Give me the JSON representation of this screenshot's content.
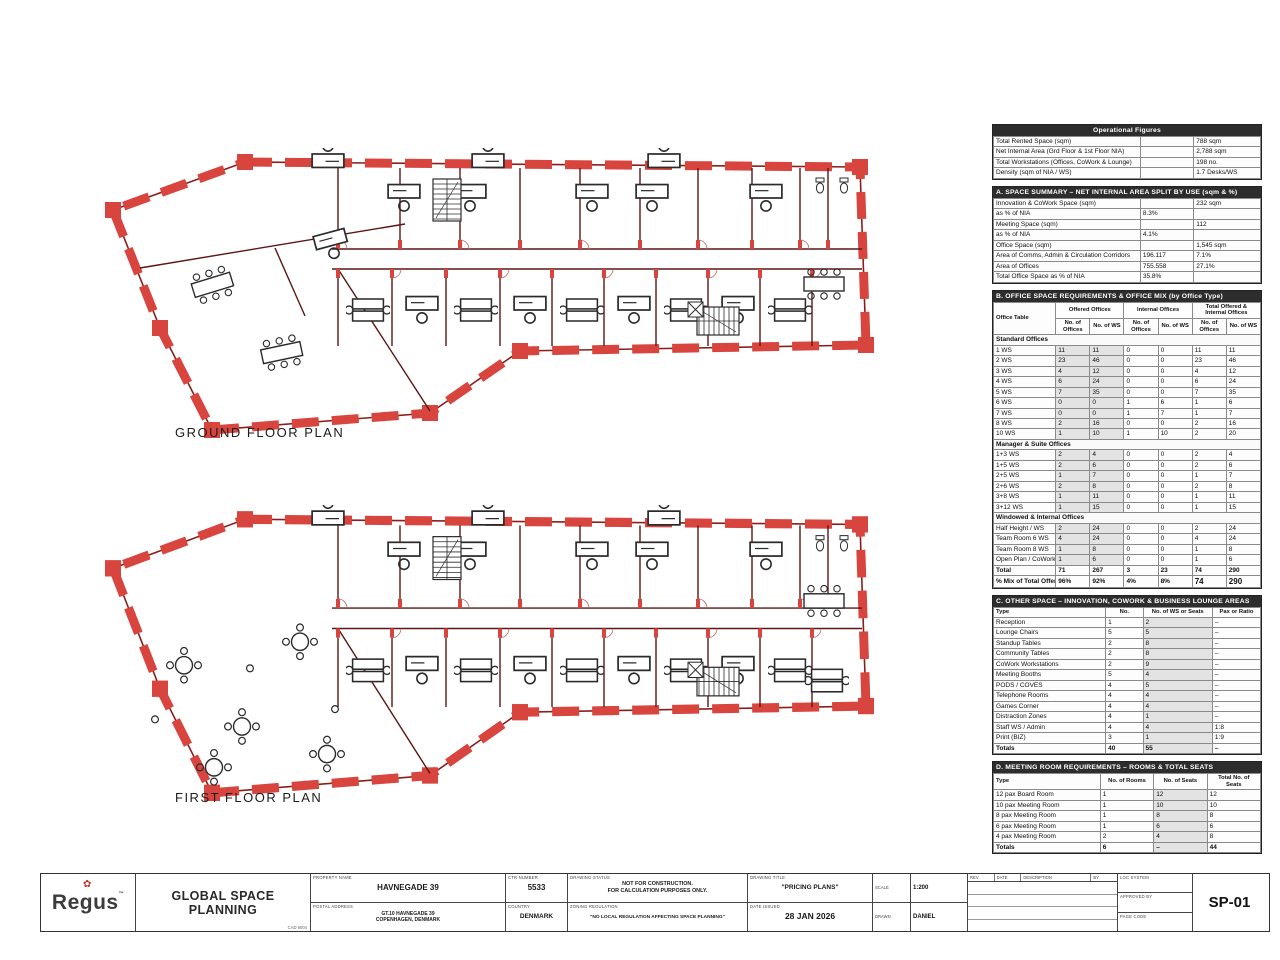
{
  "plans": {
    "ground": {
      "label": "GROUND FLOOR PLAN"
    },
    "first": {
      "label": "FIRST FLOOR PLAN"
    },
    "wall_color": "#d8453e",
    "wall_line_color": "#8a1f1a",
    "furniture_color": "#2b2b2b"
  },
  "tables": {
    "operational": {
      "title": "Operational Figures",
      "rows": [
        [
          "Total Rented Space (sqm)",
          "",
          "788 sqm"
        ],
        [
          "Net Internal Area (Grd Floor & 1st Floor NIA)",
          "",
          "2,788 sqm"
        ],
        [
          "Total Workstations (Offices, CoWork & Lounge)",
          "",
          "198 no."
        ],
        [
          "Density (sqm of NIA / WS)",
          "",
          "1.7 Desks/WS"
        ]
      ]
    },
    "sectionA": {
      "title": "A. SPACE SUMMARY – NET INTERNAL AREA SPLIT BY USE (sqm & %)",
      "rows": [
        [
          "Innovation & CoWork Space (sqm)",
          "",
          "232 sqm"
        ],
        [
          "as % of NIA",
          "8.3%",
          ""
        ],
        [
          "Meeting Space (sqm)",
          "",
          "112"
        ],
        [
          "as % of NIA",
          "4.1%",
          ""
        ],
        [
          "Office Space (sqm)",
          "",
          "1,545 sqm"
        ],
        [
          "Area of Comms, Admin & Circulation Corridors",
          "196.117",
          "7.1%"
        ],
        [
          "Area of Offices",
          "755.558",
          "27.1%"
        ],
        [
          "Total Office Space as % of NIA",
          "35.8%",
          ""
        ]
      ]
    },
    "sectionB": {
      "title": "B. OFFICE SPACE REQUIREMENTS & OFFICE MIX (by Office Type)",
      "label_header": "Office Table",
      "groups": [
        "Offered Offices",
        "Internal Offices",
        "Total Offered & Internal Offices"
      ],
      "subcols": [
        "No. of Offices",
        "No. of WS",
        "No. of Offices",
        "No. of WS",
        "No. of Offices",
        "No. of WS"
      ],
      "sections": [
        {
          "name": "Standard Offices",
          "rows": [
            [
              "1 WS",
              "11",
              "11",
              "0",
              "0",
              "11",
              "11"
            ],
            [
              "2 WS",
              "23",
              "46",
              "0",
              "0",
              "23",
              "46"
            ],
            [
              "3 WS",
              "4",
              "12",
              "0",
              "0",
              "4",
              "12"
            ],
            [
              "4 WS",
              "6",
              "24",
              "0",
              "0",
              "6",
              "24"
            ],
            [
              "5 WS",
              "7",
              "35",
              "0",
              "0",
              "7",
              "35"
            ],
            [
              "6 WS",
              "0",
              "0",
              "1",
              "6",
              "1",
              "6"
            ],
            [
              "7 WS",
              "0",
              "0",
              "1",
              "7",
              "1",
              "7"
            ],
            [
              "8 WS",
              "2",
              "16",
              "0",
              "0",
              "2",
              "16"
            ],
            [
              "10 WS",
              "1",
              "10",
              "1",
              "10",
              "2",
              "20"
            ]
          ]
        },
        {
          "name": "Manager & Suite Offices",
          "rows": [
            [
              "1+3 WS",
              "2",
              "4",
              "0",
              "0",
              "2",
              "4"
            ],
            [
              "1+5 WS",
              "2",
              "6",
              "0",
              "0",
              "2",
              "6"
            ],
            [
              "2+5 WS",
              "1",
              "7",
              "0",
              "0",
              "1",
              "7"
            ],
            [
              "2+6 WS",
              "2",
              "8",
              "0",
              "0",
              "2",
              "8"
            ],
            [
              "3+8 WS",
              "1",
              "11",
              "0",
              "0",
              "1",
              "11"
            ],
            [
              "3+12 WS",
              "1",
              "15",
              "0",
              "0",
              "1",
              "15"
            ]
          ]
        },
        {
          "name": "Windowed & Internal Offices",
          "rows": [
            [
              "Half Height / WS",
              "2",
              "24",
              "0",
              "0",
              "2",
              "24"
            ],
            [
              "Team Room 6 WS",
              "4",
              "24",
              "0",
              "0",
              "4",
              "24"
            ],
            [
              "Team Room 8 WS",
              "1",
              "8",
              "0",
              "0",
              "1",
              "8"
            ],
            [
              "Open Plan / CoWork",
              "1",
              "6",
              "0",
              "0",
              "1",
              "6"
            ]
          ]
        }
      ],
      "total": [
        "Total",
        "71",
        "267",
        "3",
        "23",
        "74",
        "290"
      ],
      "grand": [
        "% Mix of Total Offered & Internal Offices",
        "96%",
        "92%",
        "4%",
        "8%",
        "74",
        "290"
      ]
    },
    "sectionC": {
      "title": "C. OTHER SPACE – INNOVATION, COWORK & BUSINESS LOUNGE AREAS",
      "cols": [
        "Type",
        "No.",
        "No. of WS or Seats",
        "Pax or Ratio"
      ],
      "rows": [
        [
          "Reception",
          "1",
          "2",
          "–"
        ],
        [
          "Lounge Chairs",
          "5",
          "5",
          "–"
        ],
        [
          "Standup Tables",
          "2",
          "8",
          "–"
        ],
        [
          "Community Tables",
          "2",
          "8",
          "–"
        ],
        [
          "CoWork Workstations",
          "2",
          "9",
          "–"
        ],
        [
          "Meeting Booths",
          "5",
          "4",
          "–"
        ],
        [
          "PODS / COVES",
          "4",
          "5",
          "–"
        ],
        [
          "Telephone Rooms",
          "4",
          "4",
          "–"
        ],
        [
          "Games Corner",
          "4",
          "4",
          "–"
        ],
        [
          "Distraction Zones",
          "4",
          "1",
          "–"
        ],
        [
          "Staff WS / Admin",
          "4",
          "4",
          "1:8"
        ],
        [
          "Print (BIZ)",
          "3",
          "1",
          "1:9"
        ],
        [
          "Totals",
          "40",
          "55",
          "–"
        ]
      ]
    },
    "sectionD": {
      "title": "D. MEETING ROOM REQUIREMENTS – ROOMS & TOTAL SEATS",
      "cols": [
        "Type",
        "No. of Rooms",
        "No. of Seats",
        "Total No. of Seats"
      ],
      "rows": [
        [
          "12 pax Board Room",
          "1",
          "12",
          "12"
        ],
        [
          "10 pax Meeting Room",
          "1",
          "10",
          "10"
        ],
        [
          "8 pax Meeting Room",
          "1",
          "8",
          "8"
        ],
        [
          "6 pax Meeting Room",
          "1",
          "6",
          "6"
        ],
        [
          "4 pax Meeting Room",
          "2",
          "4",
          "8"
        ],
        [
          "Totals",
          "6",
          "–",
          "44"
        ]
      ]
    }
  },
  "titleblock": {
    "logo": {
      "brand": "Regus",
      "tm": "™",
      "leaf": "✿"
    },
    "dept": "GLOBAL SPACE PLANNING",
    "dept_sub": "CAD 9004",
    "fields": {
      "property_label": "PROPERTY NAME",
      "property": "HAVNEGADE 39",
      "address_label": "POSTAL ADDRESS",
      "address1": "GT.10 HAVNEGADE 39",
      "address2": "COPENHAGEN, DENMARK",
      "centre_label": "CTR NUMBER",
      "centre": "5533",
      "country_label": "COUNTRY",
      "country": "DENMARK",
      "status_label": "DRAWING STATUS",
      "status1": "NOT FOR CONSTRUCTION.",
      "status2": "FOR CALCULATION PURPOSES ONLY.",
      "zoning_label": "ZONING REGULATION",
      "zoning": "\"NO LOCAL REGULATION AFFECTING SPACE PLANNING\"",
      "title_label": "DRAWING TITLE",
      "title": "\"PRICING PLANS\"",
      "date_label": "DATE ISSUED",
      "date": "28 JAN 2026",
      "scale_label": "SCALE",
      "scale": "1:200",
      "drawn_label": "DRAWN",
      "drawn": "DANIEL",
      "sheet": "SP-01"
    },
    "rev": {
      "headers": [
        "REV",
        "DATE",
        "DESCRIPTION",
        "BY"
      ],
      "meta": [
        "LOC SYSTEM",
        "APPROVED BY",
        "PAGE CODE"
      ]
    }
  }
}
